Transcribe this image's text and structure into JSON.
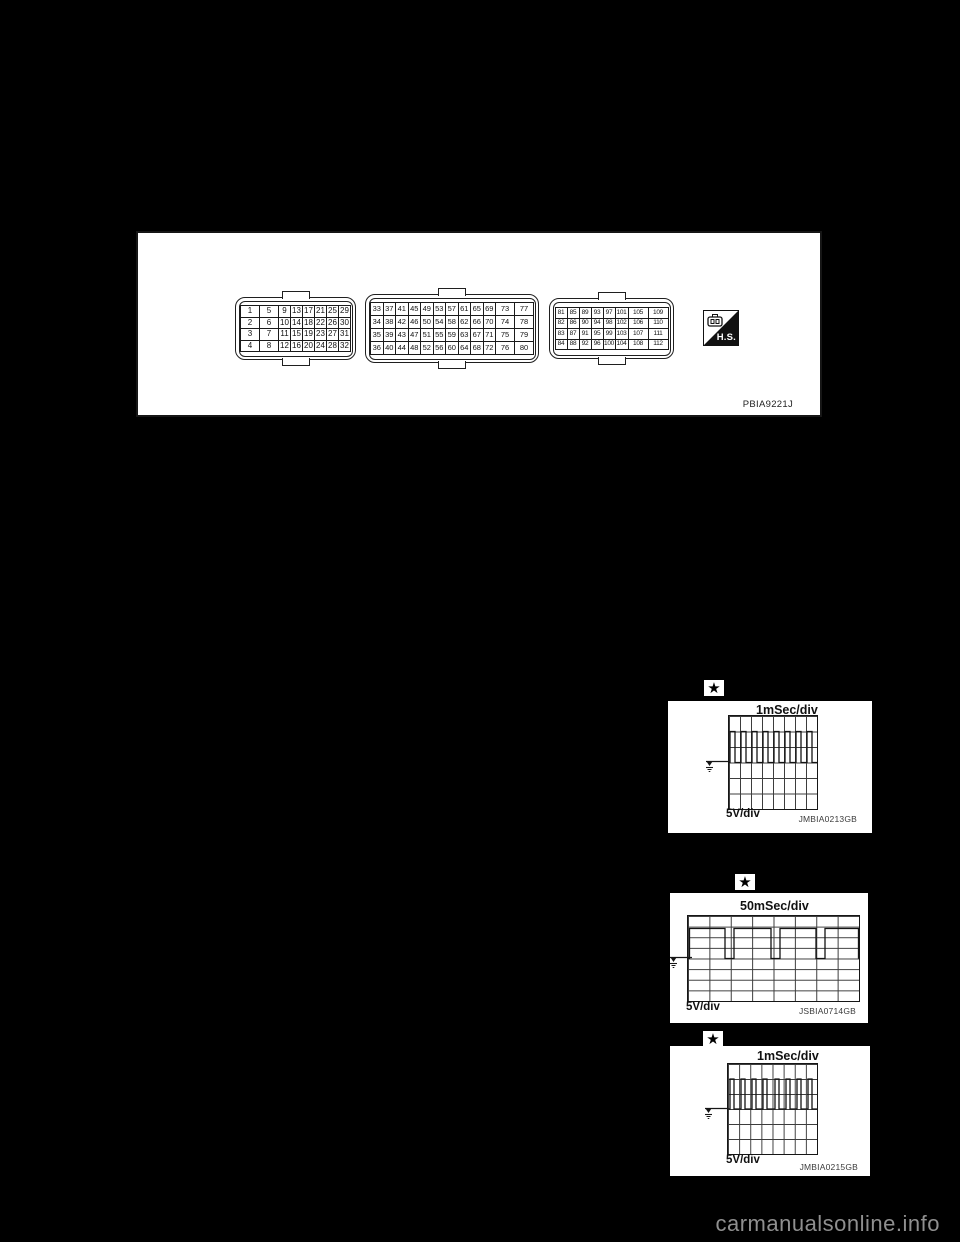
{
  "page": {
    "watermark": "carmanualsonline.info",
    "background": "#000000"
  },
  "connector_figure": {
    "code": "PBIA9221J",
    "hs_label": "H.S.",
    "connectors": [
      {
        "name": "ecm-connector-32pin",
        "rows": [
          [
            1,
            5,
            9,
            13,
            17,
            21,
            25,
            29
          ],
          [
            2,
            6,
            10,
            14,
            18,
            22,
            26,
            30
          ],
          [
            3,
            7,
            11,
            15,
            19,
            23,
            27,
            31
          ],
          [
            4,
            8,
            12,
            16,
            20,
            24,
            28,
            32
          ]
        ]
      },
      {
        "name": "ecm-connector-48pin",
        "rows": [
          [
            33,
            37,
            41,
            45,
            49,
            53,
            57,
            61,
            65,
            69,
            73,
            77
          ],
          [
            34,
            38,
            42,
            46,
            50,
            54,
            58,
            62,
            66,
            70,
            74,
            78
          ],
          [
            35,
            39,
            43,
            47,
            51,
            55,
            59,
            63,
            67,
            71,
            75,
            79
          ],
          [
            36,
            40,
            44,
            48,
            52,
            56,
            60,
            64,
            68,
            72,
            76,
            80
          ]
        ]
      },
      {
        "name": "ecm-connector-112pin",
        "rows": [
          [
            81,
            85,
            89,
            93,
            97,
            101,
            105,
            109
          ],
          [
            82,
            86,
            90,
            94,
            98,
            102,
            106,
            110
          ],
          [
            83,
            87,
            91,
            95,
            99,
            103,
            107,
            111
          ],
          [
            84,
            88,
            92,
            96,
            100,
            104,
            108,
            112
          ]
        ]
      }
    ]
  },
  "scopes": [
    {
      "star": "★",
      "time_div": "1mSec/div",
      "volt_div": "5V/div",
      "code": "JMBIA0213GB",
      "waveform_points": "0,46.5 1,46.5 1,15.5 6,15.5 6,46.5 12,46.5 12,15.5 17,15.5 17,46.5 23,46.5 23,15.5 28,15.5 28,46.5 34,46.5 34,15.5 39,15.5 39,46.5 45,46.5 45,15.5 50,15.5 50,46.5 56,46.5 56,15.5 61,15.5 61,46.5 67,46.5 67,15.5 72,15.5 72,46.5 78,46.5 78,15.5 83,15.5 83,46.5 88,46.5"
    },
    {
      "star": "★",
      "time_div": "50mSec/div",
      "volt_div": "5V/div",
      "code": "JSBIA0714GB",
      "waveform_points": "0,42.5 1.5,42.5 1.5,12.5 37,12.5 37,42.5 46,42.5 46,12.5 83,12.5 83,42.5 92,42.5 92,12.5 128,12.5 128,42.5 137,42.5 137,12.5 170.5,12.5 170.5,42.5"
    },
    {
      "star": "★",
      "time_div": "1mSec/div",
      "volt_div": "5V/div",
      "code": "JMBIA0215GB",
      "waveform_points": "0,45 2,45 2,15 6,15 6,45 13,45 13,15 17,15 17,45 24,45 24,15 28,15 28,45 35,45 35,15 39,15 39,45 47,45 47,15 51,15 51,45 58,45 58,15 62,15 62,45 69,45 69,15 73,15 73,45 80,45 80,15 84,15 84,45 89,45"
    }
  ],
  "chart_data": [
    {
      "type": "line",
      "title": "1mSec/div",
      "ylabel": "5V/div",
      "code": "JMBIA0213GB",
      "grid": {
        "columns": 8,
        "rows": 6
      },
      "signal": {
        "shape": "pulse-train",
        "pulses": 8,
        "period_divs": 1,
        "high_width_divs": 0.45,
        "baseline_rows_from_top": 3,
        "amplitude_divs": 2,
        "amplitude_volts": 10
      }
    },
    {
      "type": "line",
      "title": "50mSec/div",
      "ylabel": "5V/div",
      "code": "JSBIA0714GB",
      "grid": {
        "columns": 8,
        "rows": 8
      },
      "signal": {
        "shape": "square-wave-mostly-high",
        "low_dips": 4,
        "period_divs": 2.1,
        "low_width_divs": 0.45,
        "high_rows_from_top": 1.2,
        "low_rows_from_top": 4,
        "amplitude_volts": 14
      }
    },
    {
      "type": "line",
      "title": "1mSec/div",
      "ylabel": "5V/div",
      "code": "JMBIA0215GB",
      "grid": {
        "columns": 8,
        "rows": 6
      },
      "signal": {
        "shape": "pulse-train",
        "pulses": 8,
        "period_divs": 1,
        "high_width_divs": 0.35,
        "baseline_rows_from_top": 3,
        "amplitude_divs": 2,
        "amplitude_volts": 10
      }
    }
  ]
}
